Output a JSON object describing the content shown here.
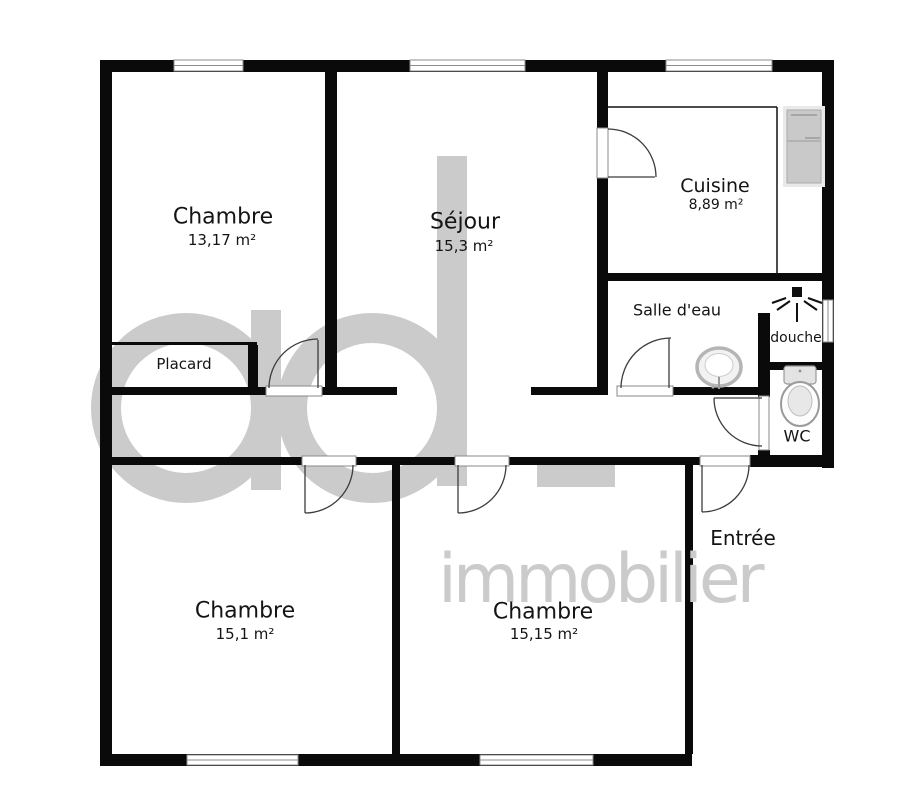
{
  "watermark": {
    "logo_text": "ad",
    "brand_text": "immobilier",
    "color": "#cbcbcb"
  },
  "plan": {
    "wall_color": "#0a0a0a",
    "background": "#ffffff"
  },
  "rooms": [
    {
      "id": "chambre-tl",
      "name": "Chambre",
      "area": "13,17 m²"
    },
    {
      "id": "sejour",
      "name": "Séjour",
      "area": "15,3 m²"
    },
    {
      "id": "cuisine",
      "name": "Cuisine",
      "area": "8,89 m²"
    },
    {
      "id": "salle-deau",
      "name": "Salle d'eau"
    },
    {
      "id": "douche",
      "name": "douche"
    },
    {
      "id": "wc",
      "name": "WC"
    },
    {
      "id": "placard",
      "name": "Placard"
    },
    {
      "id": "entree",
      "name": "Entrée"
    },
    {
      "id": "chambre-bl",
      "name": "Chambre",
      "area": "15,1 m²"
    },
    {
      "id": "chambre-bm",
      "name": "Chambre",
      "area": "15,15 m²"
    }
  ]
}
